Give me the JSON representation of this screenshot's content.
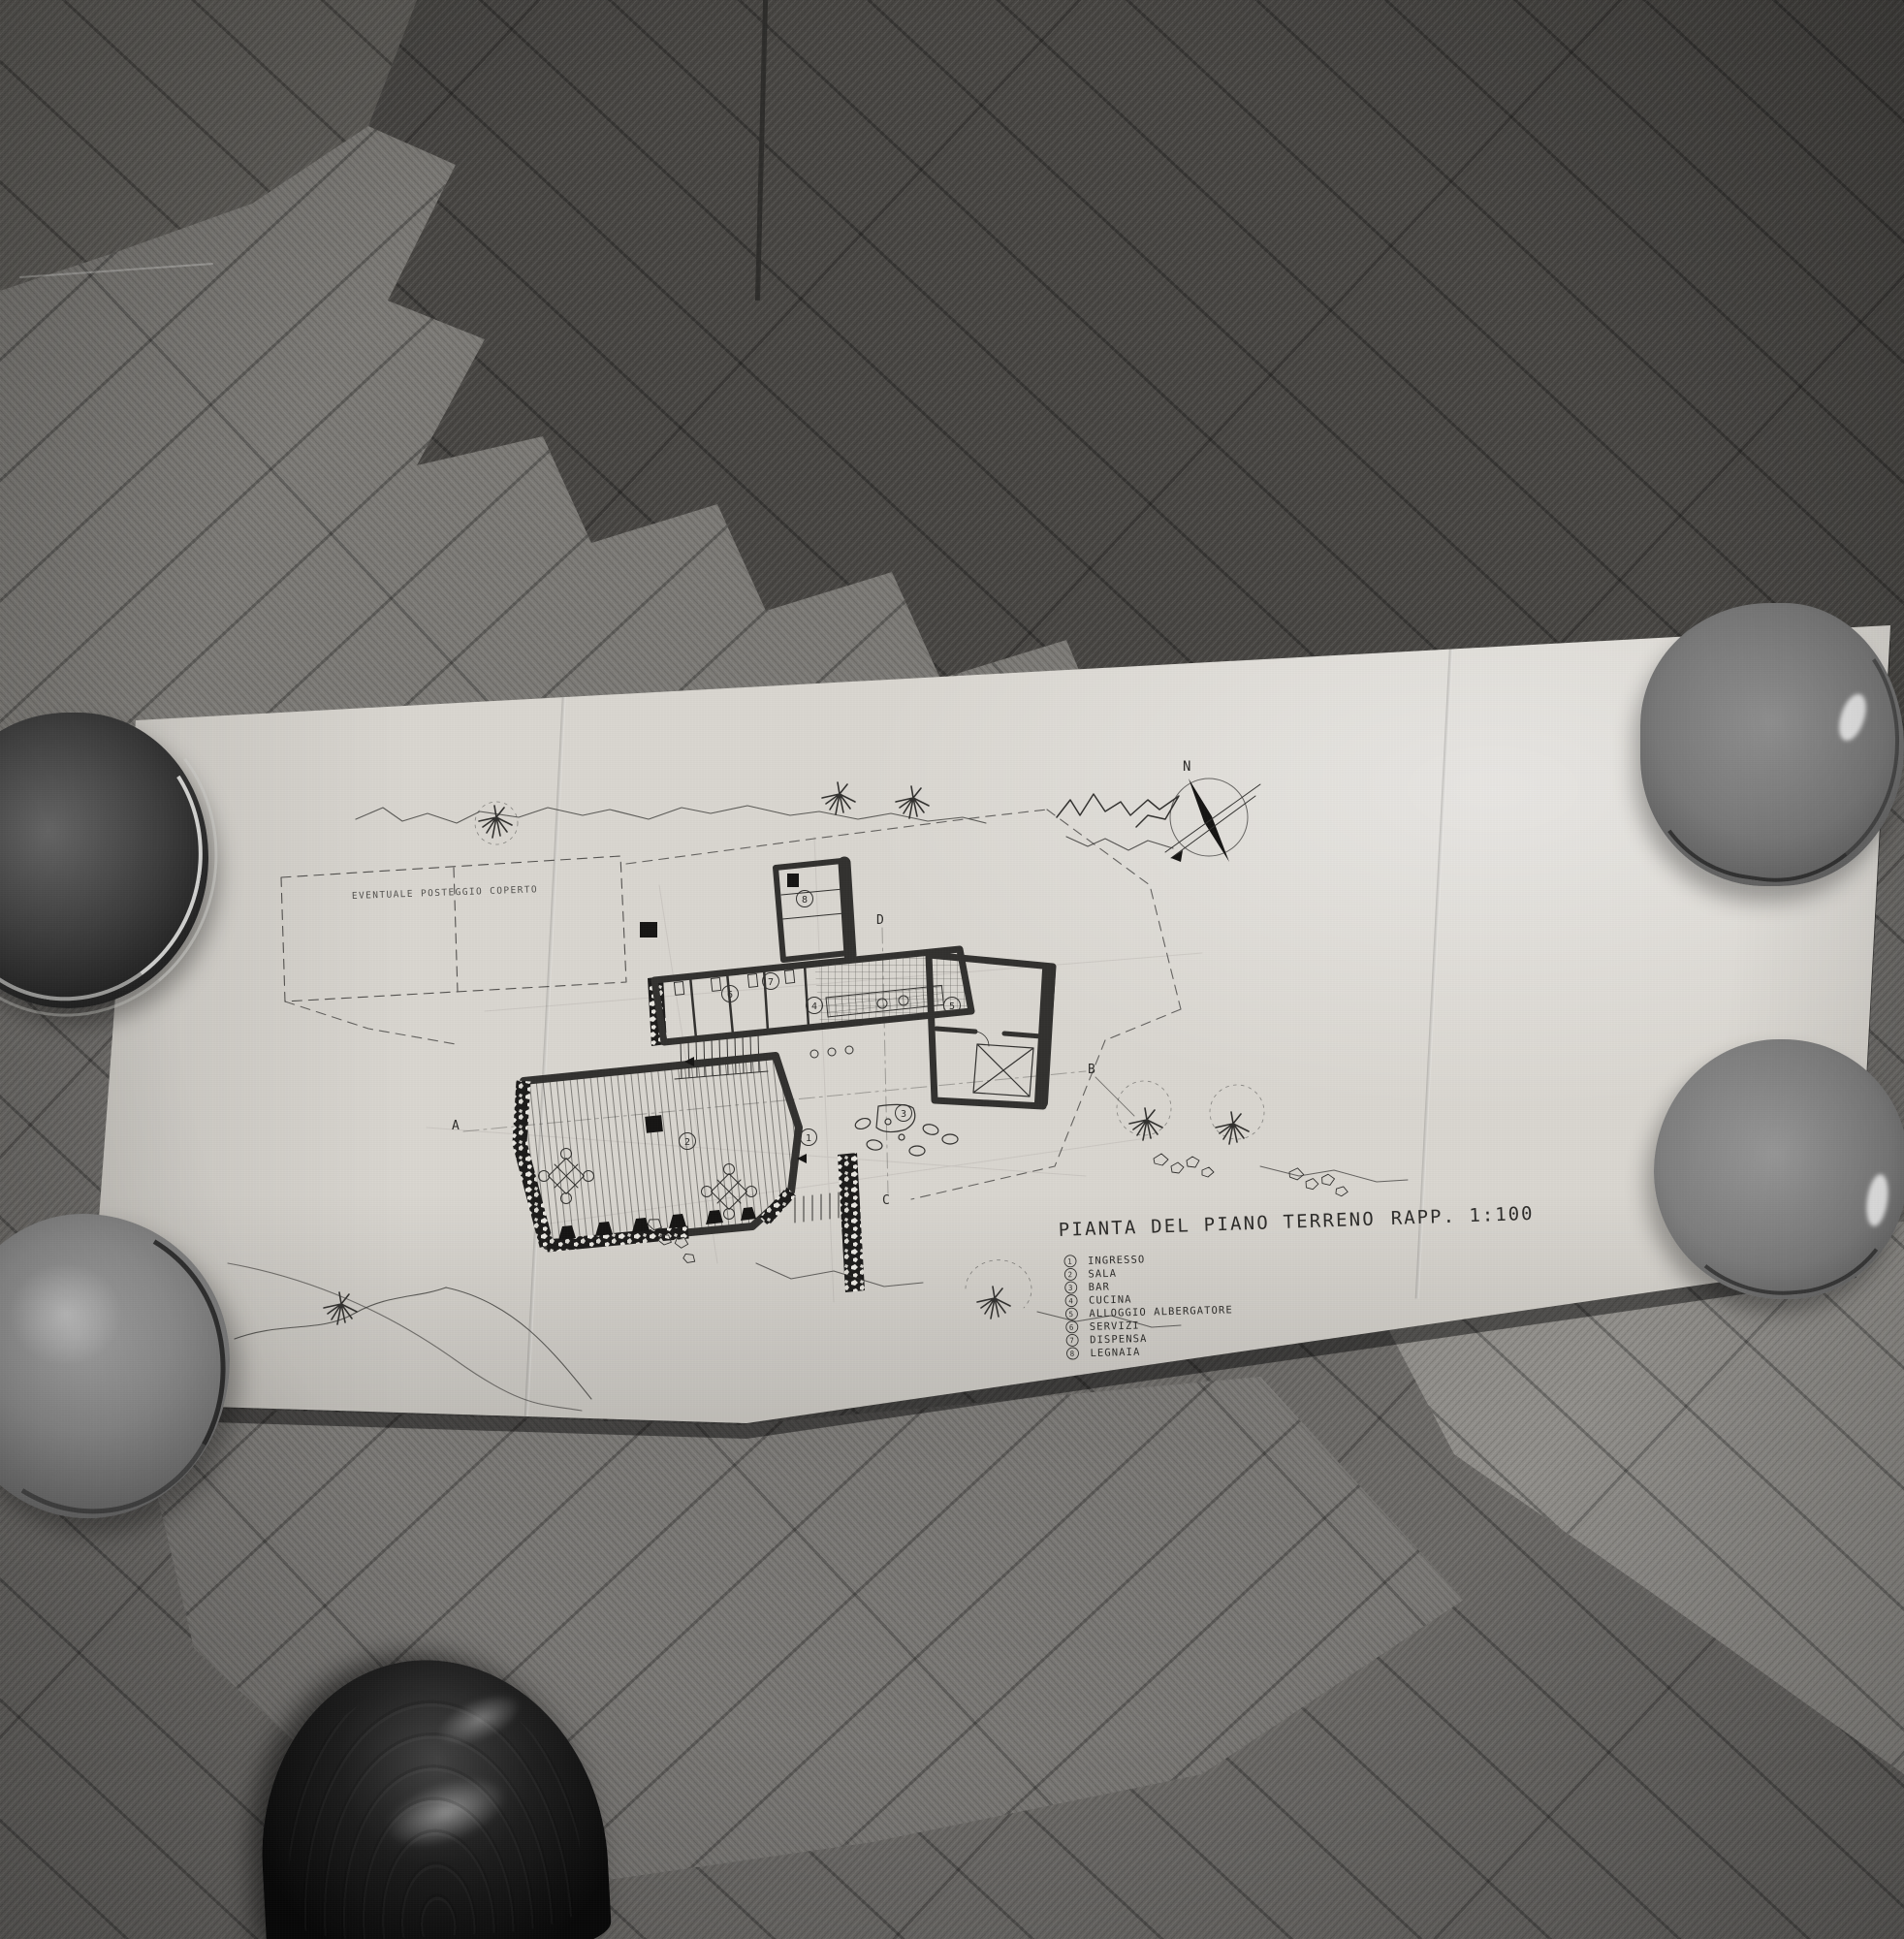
{
  "scene": {
    "objects": [
      "parquet-floor",
      "folded-drawing-sheet",
      "ceramic-bowl",
      "leather-shoe"
    ]
  },
  "drawing": {
    "title": "PIANTA DEL PIANO TERRENO",
    "scale_label": "RAPP. 1:100",
    "parking_note": "EVENTUALE POSTEGGIO COPERTO",
    "compass_label": "N",
    "rooms": [
      {
        "num": "1"
      },
      {
        "num": "2"
      },
      {
        "num": "3"
      },
      {
        "num": "4"
      },
      {
        "num": "5"
      },
      {
        "num": "6"
      },
      {
        "num": "7"
      },
      {
        "num": "8"
      }
    ],
    "sections": [
      {
        "label": "A"
      },
      {
        "label": "B"
      },
      {
        "label": "C"
      },
      {
        "label": "D"
      }
    ],
    "legend": {
      "items": [
        {
          "num": "1",
          "label": "INGRESSO"
        },
        {
          "num": "2",
          "label": "SALA"
        },
        {
          "num": "3",
          "label": "BAR"
        },
        {
          "num": "4",
          "label": "CUCINA"
        },
        {
          "num": "5",
          "label": "ALLOGGIO ALBERGATORE"
        },
        {
          "num": "6",
          "label": "SERVIZI"
        },
        {
          "num": "7",
          "label": "DISPENSA"
        },
        {
          "num": "8",
          "label": "LEGNAIA"
        }
      ]
    }
  },
  "colors": {
    "paper": "#d9d6d0",
    "ink": "#32312f",
    "floor_dark": "#484643",
    "floor_mid": "#6b6966",
    "floor_light": "#8f8d89",
    "bowl_gray": "#8a8a8a",
    "shoe_black": "#0a0a0a"
  }
}
